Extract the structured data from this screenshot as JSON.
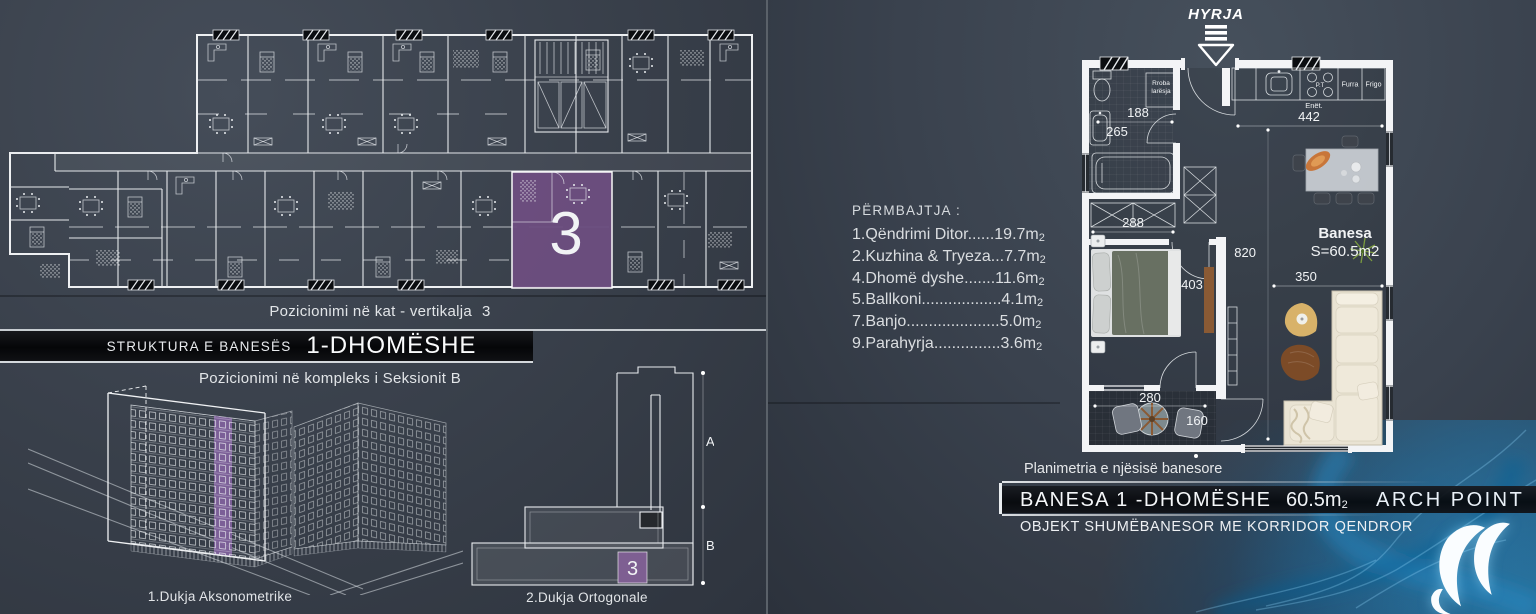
{
  "colors": {
    "accent_purple": "#6f4f82",
    "blue_glow": "#1a86c8",
    "wall_white": "#f2f3f4"
  },
  "left_panel": {
    "floor_plan_caption": "Pozicionimi në kat - vertikalja",
    "floor_plan_caption_number": "3",
    "highlighted_unit": "3",
    "structure_banner": {
      "prefix": "STRUKTURA E BANESËS",
      "title": "1-DHOMËSHE"
    },
    "complex_caption": "Pozicionimi në kompleks i Seksionit B",
    "axonometric_caption": "1.Dukja Aksonometrike",
    "orthogonal_caption": "2.Dukja Ortogonale",
    "orthogonal_view": {
      "section_a": "A",
      "section_b": "B",
      "unit_number": "3"
    }
  },
  "right_panel": {
    "entry_label": "HYRJA",
    "contents_list": {
      "header": "PËRMBAJTJA :",
      "sub": "2",
      "items": [
        {
          "text": "1.Qëndrimi Ditor......19.7m"
        },
        {
          "text": "2.Kuzhina & Tryeza...7.7m"
        },
        {
          "text": "4.Dhomë dyshe.......11.6m"
        },
        {
          "text": "5.Ballkoni..................4.1m"
        },
        {
          "text": "7.Banjo.....................5.0m"
        },
        {
          "text": "9.Parahyrja...............3.6m"
        }
      ]
    },
    "plan": {
      "labels": {
        "washer_1": "Rroba",
        "washer_2": "larësja",
        "oven": "Furra",
        "fridge": "Frigo",
        "dishes": "Enët.",
        "stove": "P.T",
        "unit_name": "Banesa",
        "unit_area": "S=60.5m2"
      },
      "dimensions": {
        "d188": "188",
        "d265": "265",
        "d442": "442",
        "d288": "288",
        "d820": "820",
        "d403": "403",
        "d350": "350",
        "d280": "280",
        "d160": "160"
      }
    },
    "plan_caption": "Planimetria e njësisë banesore",
    "title_banner": {
      "title": "BANESA 1 -DHOMËSHE",
      "area": "60.5m",
      "area_sub": "2",
      "brand": "ARCH POINT"
    },
    "subtitle": "OBJEKT SHUMËBANESOR ME KORRIDOR QENDROR"
  }
}
